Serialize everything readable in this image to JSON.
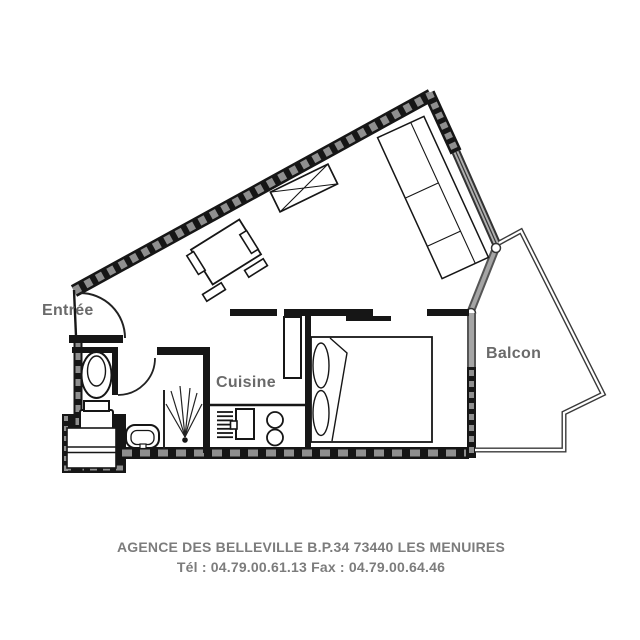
{
  "colors": {
    "background": "#ffffff",
    "wall": "#161616",
    "wall_hatch": "#8f8f8f",
    "window_glass": "#a5a5a5",
    "room_label": "#6a6a6a",
    "footer_text": "#7c7c7c"
  },
  "rooms": {
    "entree": "Entrée",
    "cuisine": "Cuisine",
    "balcon": "Balcon"
  },
  "footer": {
    "line1": "AGENCE DES BELLEVILLE B.P.34 73440 LES MENUIRES",
    "line2": "Tél : 04.79.00.61.13  Fax : 04.79.00.64.46"
  },
  "furniture_icons": [
    "sofa-icon",
    "sideboard-icon",
    "dining-table-icon",
    "chair-icon",
    "double-bed-icon",
    "pillow-icon",
    "fridge-icon",
    "kitchen-counter-icon",
    "kitchen-sink-icon",
    "drainer-icon",
    "hob-burner-icon",
    "toilet-icon",
    "washbasin-icon",
    "shower-icon",
    "bathroom-cabinet-icon",
    "entrance-door-icon",
    "bathroom-door-icon"
  ]
}
